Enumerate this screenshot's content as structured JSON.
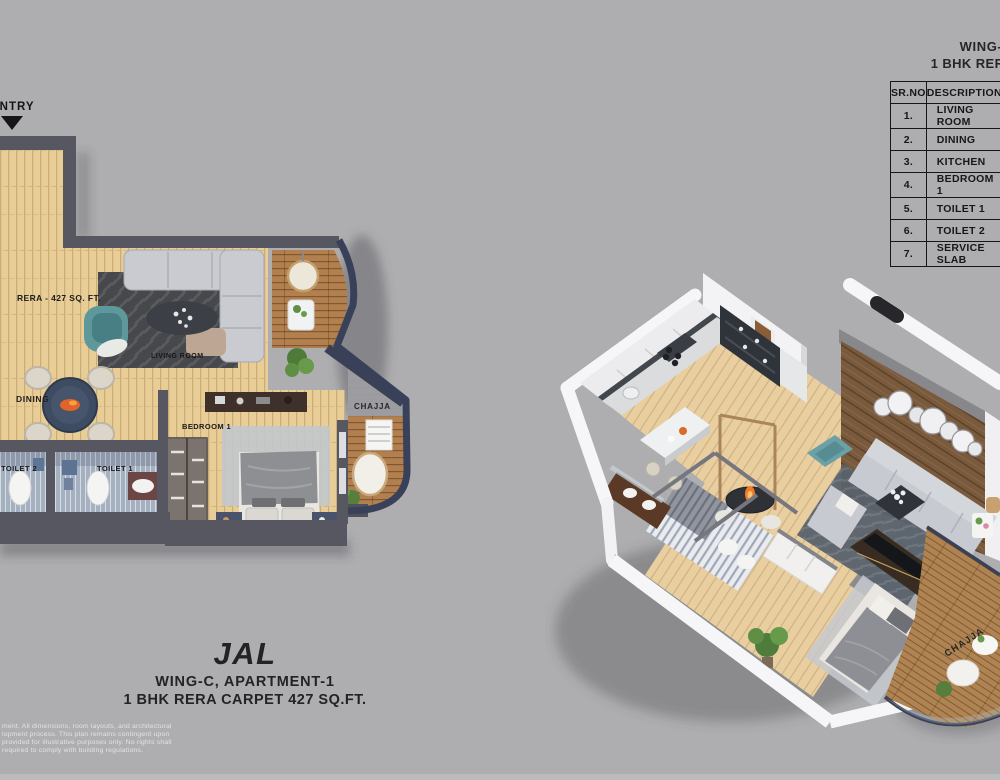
{
  "entry_marker": {
    "label": "ENTRY"
  },
  "plan2d": {
    "labels": {
      "rera": "RERA - 427 SQ. FT.",
      "living_room": "LIVING ROOM",
      "dining": "DINING",
      "toilet2": "TOILET 2",
      "toilet1": "TOILET 1",
      "bedroom1": "BEDROOM 1",
      "chajja": "CHAJJA"
    }
  },
  "plan3d": {
    "labels": {
      "chajja": "CHAJJA"
    }
  },
  "unit_title": {
    "name": "JAL",
    "subtitle": "WING-C, APARTMENT-1",
    "carpet": "1 BHK RERA CARPET 427 SQ.FT."
  },
  "legend_title": {
    "name": "JAL",
    "subtitle": "WING-C, APARTMENT-1",
    "carpet": "1 BHK RERA CARPET 427 SQ.FT."
  },
  "legend_table": {
    "headers": [
      "SR.NO",
      "DESCRIPTION"
    ],
    "rows": [
      [
        "1.",
        "LIVING ROOM"
      ],
      [
        "2.",
        "DINING"
      ],
      [
        "3.",
        "KITCHEN"
      ],
      [
        "4.",
        "BEDROOM 1"
      ],
      [
        "5.",
        "TOILET 1"
      ],
      [
        "6.",
        "TOILET 2"
      ],
      [
        "7.",
        "SERVICE SLAB"
      ]
    ]
  },
  "disclaimer": {
    "lines": [
      "ment. All dimensions, room layouts, and architectural",
      "lopment process. This plan remains contingent upon",
      "provided for illustrative purposes only. No rights shall",
      "required to comply with building regulations."
    ]
  },
  "palette": {
    "background": "#AEAEB0",
    "wall_dark": "#575762",
    "wood_floor": "#E7CB93",
    "deck_wood": "#B2804E",
    "outline_navy": "#3A4156",
    "accent_teal": "#5E989B",
    "text_dark": "#1D1D1D"
  }
}
